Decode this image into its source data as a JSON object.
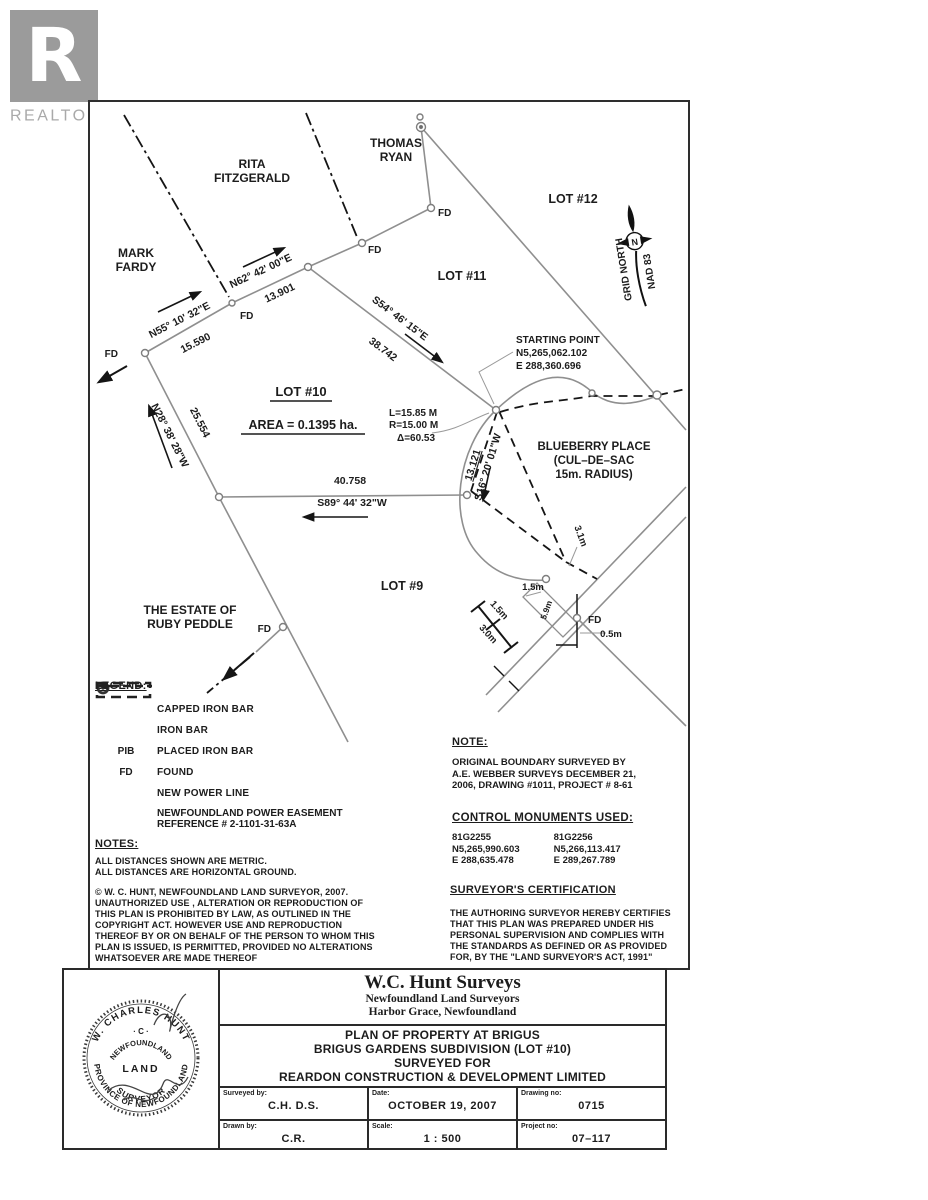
{
  "logo": {
    "letter": "R",
    "label": "REALTOR",
    "reg": "®"
  },
  "map": {
    "neighbors": {
      "rita1": "RITA",
      "rita2": "FITZGERALD",
      "thomas1": "THOMAS",
      "thomas2": "RYAN",
      "mark1": "MARK",
      "mark2": "FARDY",
      "estate1": "THE ESTATE OF",
      "estate2": "RUBY PEDDLE"
    },
    "lots": {
      "lot12": "LOT #12",
      "lot11": "LOT #11",
      "lot10": "LOT #10",
      "lot9": "LOT #9",
      "area": "AREA = 0.1395 ha."
    },
    "bearings": {
      "n55b": "N55° 10' 32\"E",
      "n55d": "15.590",
      "n62b": "N62° 42' 00\"E",
      "n62d": "13.901",
      "s54b": "S54° 46' 15\"E",
      "s54d": "38.742",
      "n28b": "N28° 38' 28\"W",
      "n28d": "25.554",
      "s89b": "S89° 44' 32\"W",
      "s89d": "40.758",
      "s16b": "S16° 20' 01\"W",
      "s16d": "13.121"
    },
    "starting_point": {
      "l1": "STARTING POINT",
      "l2": "N5,265,062.102",
      "l3": "E  288,360.696"
    },
    "curve": {
      "l1": "L=15.85 M",
      "l2": "R=15.00 M",
      "l3": "Δ=60.53"
    },
    "blueberry": {
      "l1": "BLUEBERRY PLACE",
      "l2": "(CUL–DE–SAC",
      "l3": "15m. RADIUS)"
    },
    "compass": {
      "north": "GRID NORTH",
      "datum": "NAD 83",
      "n": "N"
    },
    "fd": "FD",
    "dims": {
      "d31": "3.1m",
      "d15a": "1.5m",
      "d15b": "1.5m",
      "d30": "3.0m",
      "d05": "0.5m",
      "d59": "5.9m"
    }
  },
  "legend": {
    "title": "LEGEND:",
    "items": [
      {
        "sym": "capped-iron-bar",
        "label": "CAPPED IRON BAR"
      },
      {
        "sym": "iron-bar",
        "label": "IRON BAR"
      },
      {
        "sym": "PIB",
        "sym_text": "PIB",
        "label": "PLACED IRON BAR"
      },
      {
        "sym": "FD",
        "sym_text": "FD",
        "label": "FOUND"
      },
      {
        "sym": "new-power-line",
        "label": "NEW POWER LINE"
      },
      {
        "sym": "easement",
        "label": "NEWFOUNDLAND POWER EASEMENT",
        "label2": "REFERENCE # 2-1101-31-63A"
      }
    ]
  },
  "notes": {
    "title": "NOTES:",
    "lines": [
      "ALL DISTANCES SHOWN ARE METRIC.",
      "ALL DISTANCES ARE HORIZONTAL GROUND."
    ],
    "copyright": [
      "© W. C. HUNT, NEWFOUNDLAND LAND SURVEYOR, 2007.",
      "UNAUTHORIZED USE , ALTERATION OR REPRODUCTION OF",
      "THIS PLAN IS PROHIBITED BY LAW, AS OUTLINED IN THE",
      "COPYRIGHT ACT.  HOWEVER USE AND REPRODUCTION",
      "THEREOF BY OR ON BEHALF OF THE PERSON TO WHOM THIS",
      "PLAN IS ISSUED, IS PERMITTED, PROVIDED NO ALTERATIONS",
      "WHATSOEVER ARE MADE THEREOF"
    ]
  },
  "note_right": {
    "title": "NOTE:",
    "lines": [
      "ORIGINAL BOUNDARY SURVEYED BY",
      "A.E. WEBBER SURVEYS DECEMBER 21,",
      "2006, DRAWING #1011, PROJECT # 8-61"
    ]
  },
  "monuments": {
    "title": "CONTROL MONUMENTS USED:",
    "col1": [
      "81G2255",
      "N5,265,990.603",
      "E 288,635.478"
    ],
    "col2": [
      "81G2256",
      "N5,266,113.417",
      "E 289,267.789"
    ]
  },
  "certification": {
    "title": "SURVEYOR'S CERTIFICATION",
    "lines": [
      "THE AUTHORING SURVEYOR HEREBY CERTIFIES",
      "THAT THIS PLAN WAS PREPARED UNDER HIS",
      "PERSONAL SUPERVISION AND COMPLIES WITH",
      "THE STANDARDS AS DEFINED OR AS PROVIDED",
      "FOR, BY THE \"LAND SURVEYOR'S ACT, 1991\""
    ]
  },
  "titleblock": {
    "firm": {
      "name": "W.C. Hunt Surveys",
      "sub1": "Newfoundland Land Surveyors",
      "sub2": "Harbor Grace,  Newfoundland"
    },
    "plan": {
      "l1": "PLAN OF PROPERTY AT BRIGUS",
      "l2": "BRIGUS GARDENS SUBDIVISION (LOT #10)",
      "l3": "SURVEYED FOR",
      "l4": "REARDON CONSTRUCTION & DEVELOPMENT LIMITED"
    },
    "fields": {
      "surveyed_label": "Surveyed by:",
      "surveyed": "C.H.    D.S.",
      "date_label": "Date:",
      "date": "OCTOBER 19, 2007",
      "drawing_label": "Drawing no:",
      "drawing": "0715",
      "drawn_label": "Drawn by:",
      "drawn": "C.R.",
      "scale_label": "Scale:",
      "scale": "1 : 500",
      "project_label": "Project no:",
      "project": "07–117"
    }
  },
  "stamp": {
    "arc_top": "W. CHARLES HUNT",
    "arc_bottom": "PROVINCE OF NEWFOUNDLAND",
    "initials": "· C ·",
    "inner_top": "NEWFOUNDLAND",
    "center": "LAND",
    "inner_bottom": "SURVEYOR"
  }
}
